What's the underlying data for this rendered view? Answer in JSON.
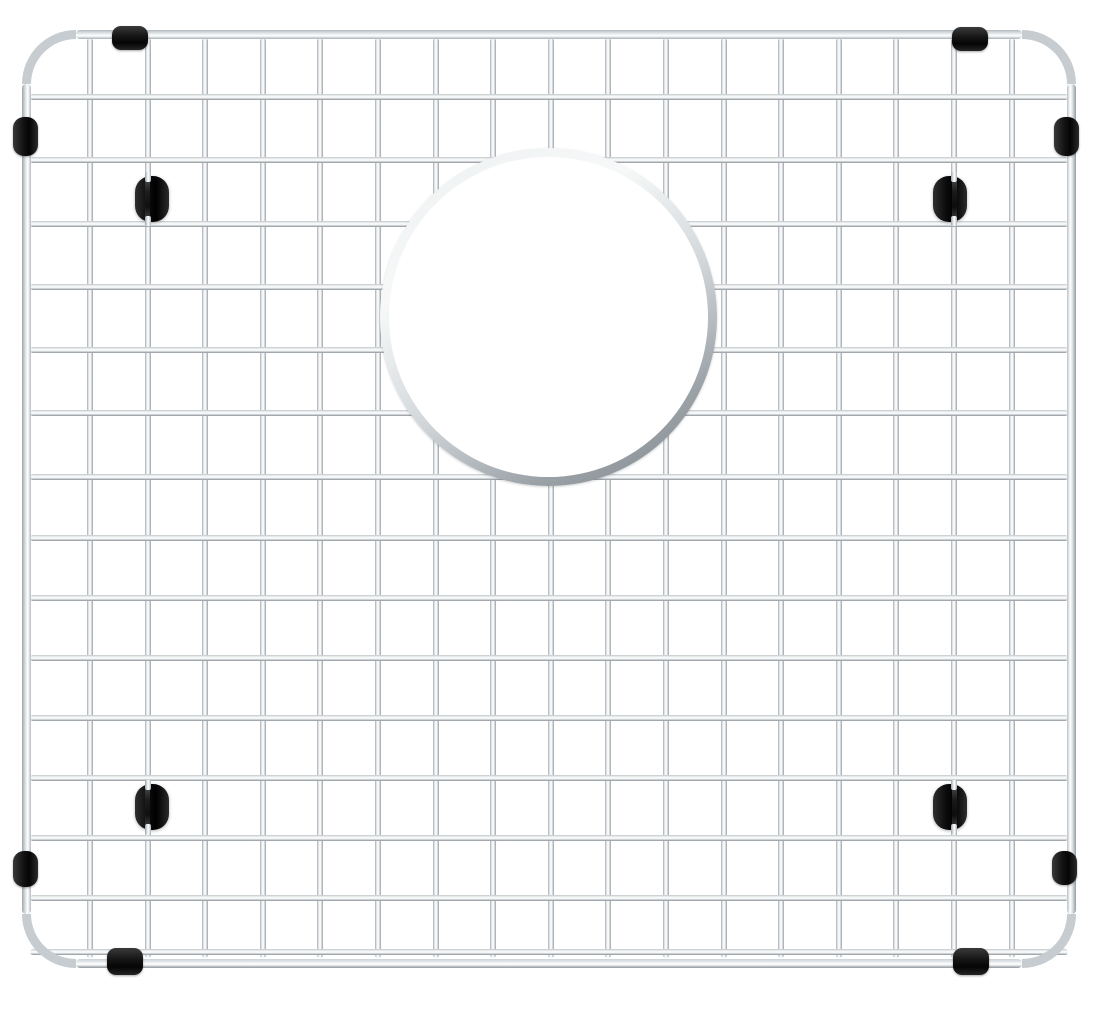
{
  "image": {
    "type": "product-photo",
    "subject": "Stainless steel sink bottom grid",
    "description": "Polished stainless steel wire sink grid with a rounded-corner outer frame, a circular drain opening in the upper center, black rubber edge clips and side bumpers, and four black rubber feet mounted on the wires",
    "background_color": "#ffffff"
  },
  "grid": {
    "columns": 18,
    "rows": 16,
    "vertical_wire_count": 17,
    "horizontal_wire_count": 15,
    "wire_color": "#cdd2d6",
    "wire_highlight_color": "#ffffff",
    "wire_shadow_color": "#8b9298",
    "frame_style": "rounded-corner tube frame"
  },
  "drain_opening": {
    "shape": "circle",
    "position": "upper-center",
    "rim_color": "#c9ced2",
    "interior_color": "#ffffff"
  },
  "bumpers": {
    "color": "#141414",
    "top_clip_count": 2,
    "bottom_clip_count": 2,
    "side_bumper_count": 4,
    "foot_count": 4
  }
}
